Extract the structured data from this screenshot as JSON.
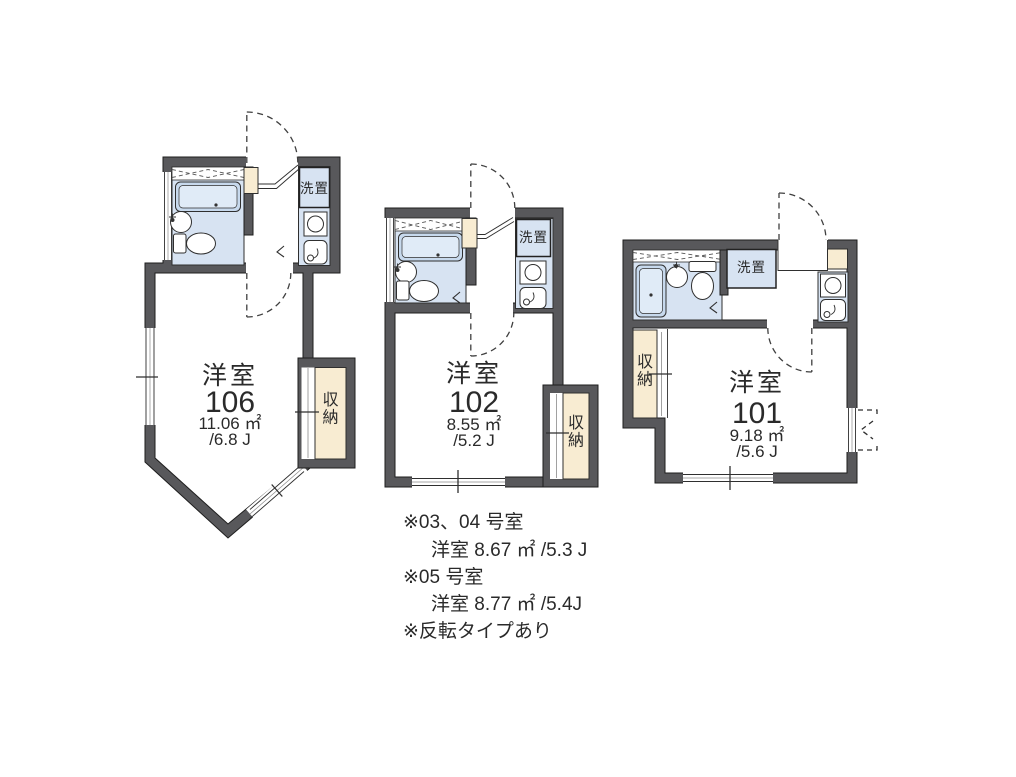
{
  "palette": {
    "wall": "#58585b",
    "fixture_blue": "#d7e3f2",
    "fixture_blue_dark": "#c7d9ed",
    "fixture_blue_light": "#e0ebf7",
    "closet_cream": "#f8ecd2",
    "outline": "#1e1e1e",
    "text": "#2a2a2a"
  },
  "units": [
    {
      "name": "106",
      "type_label": "洋室",
      "number": "106",
      "area": "11.06 ㎡",
      "tatami": "/6.8 J",
      "closet": "収納",
      "washer": "洗置"
    },
    {
      "name": "102",
      "type_label": "洋室",
      "number": "102",
      "area": "8.55 ㎡",
      "tatami": "/5.2 J",
      "closet": "収納",
      "washer": "洗置"
    },
    {
      "name": "101",
      "type_label": "洋室",
      "number": "101",
      "area": "9.18 ㎡",
      "tatami": "/5.6 J",
      "closet": "収納",
      "washer": "洗置"
    }
  ],
  "notes": [
    "※03、04 号室",
    "洋室 8.67 ㎡ /5.3 J",
    "※05 号室",
    "洋室 8.77 ㎡ /5.4J",
    "※反転タイプあり"
  ]
}
